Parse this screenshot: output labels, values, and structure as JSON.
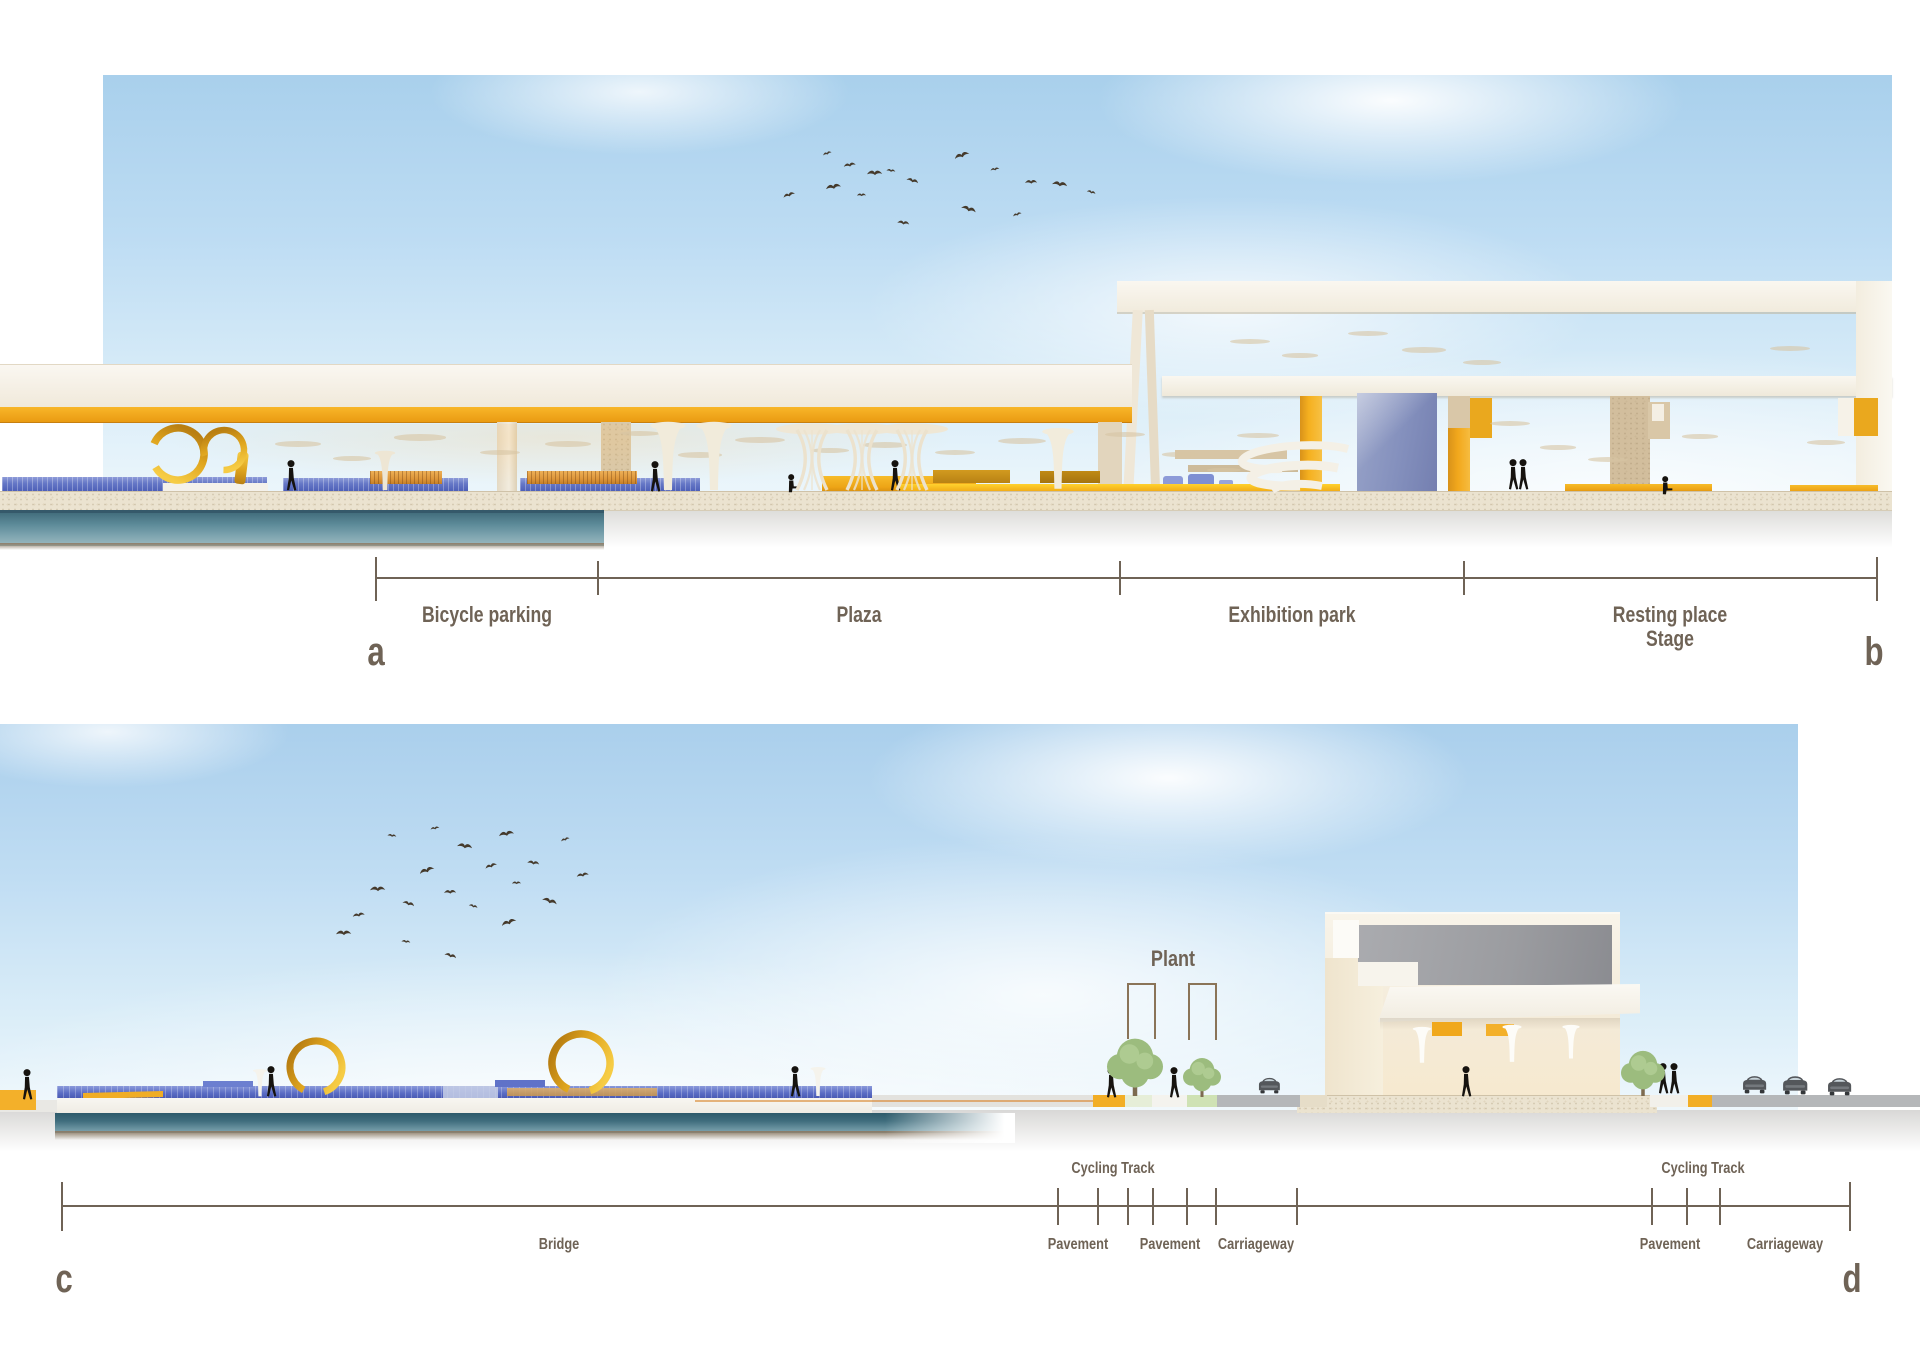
{
  "meta": {
    "sheet_type": "architectural section elevations",
    "panels": [
      "a-b",
      "c-d"
    ]
  },
  "colors": {
    "annotation": "#6f6356",
    "gold": "#dfa51e",
    "canopy_yellow": "#f2a81c",
    "bench_blue": "#6e7ec9",
    "water_teal": "#3f6d7d",
    "ground_beige": "#ebe3d0",
    "road_gray": "#b5b7b9",
    "sky_blue": "#b6d8f0"
  },
  "top_section": {
    "dim_line": {
      "y": 578,
      "x_start": 376,
      "x_end": 1877,
      "ticks": [
        376,
        598,
        1120,
        1464,
        1877
      ],
      "labels_below": [
        {
          "text": "Bicycle parking",
          "x": 487
        },
        {
          "text": "Plaza",
          "x": 859
        },
        {
          "text": "Exhibition park",
          "x": 1292
        },
        {
          "text": "Resting place",
          "text2": "Stage",
          "x": 1670
        }
      ],
      "labels_above": []
    },
    "markers": [
      {
        "text": "a",
        "x": 376,
        "y": 630
      },
      {
        "text": "b",
        "x": 1874,
        "y": 630
      }
    ]
  },
  "bottom_section": {
    "dim_line": {
      "y": 1206,
      "x_start": 62,
      "x_end": 1850,
      "ticks": [
        62,
        1058,
        1098,
        1128,
        1153,
        1187,
        1216,
        1297,
        1652,
        1687,
        1720,
        1850
      ],
      "labels_below": [
        {
          "text": "Bridge",
          "x": 559
        },
        {
          "text": "Pavement",
          "x": 1078
        },
        {
          "text": "Pavement",
          "x": 1170
        },
        {
          "text": "Carriageway",
          "x": 1256
        },
        {
          "text": "Pavement",
          "x": 1670
        },
        {
          "text": "Carriageway",
          "x": 1785
        }
      ],
      "labels_above": [
        {
          "text": "Cycling Track",
          "x": 1113
        },
        {
          "text": "Cycling Track",
          "x": 1703
        }
      ]
    },
    "markers": [
      {
        "text": "c",
        "x": 64,
        "y": 1257
      },
      {
        "text": "d",
        "x": 1852,
        "y": 1257
      }
    ],
    "plant_label": {
      "text": "Plant",
      "x": 1173,
      "y": 946
    }
  },
  "scene": {
    "birds_top": [
      [
        822,
        152
      ],
      [
        843,
        162
      ],
      [
        867,
        168
      ],
      [
        887,
        167
      ],
      [
        908,
        175
      ],
      [
        953,
        153
      ],
      [
        990,
        167
      ],
      [
        1025,
        178
      ],
      [
        1053,
        178
      ],
      [
        1088,
        188
      ],
      [
        782,
        193
      ],
      [
        825,
        183
      ],
      [
        857,
        192
      ],
      [
        898,
        218
      ],
      [
        963,
        202
      ],
      [
        1012,
        213
      ]
    ],
    "birds_bottom": [
      [
        352,
        912
      ],
      [
        370,
        884
      ],
      [
        388,
        832
      ],
      [
        404,
        898
      ],
      [
        418,
        868
      ],
      [
        430,
        826
      ],
      [
        444,
        888
      ],
      [
        458,
        840
      ],
      [
        470,
        902
      ],
      [
        484,
        864
      ],
      [
        498,
        830
      ],
      [
        512,
        880
      ],
      [
        528,
        858
      ],
      [
        544,
        894
      ],
      [
        560,
        838
      ],
      [
        576,
        872
      ],
      [
        336,
        928
      ],
      [
        402,
        938
      ],
      [
        446,
        950
      ],
      [
        500,
        920
      ]
    ],
    "people": [
      [
        284,
        460,
        "walk"
      ],
      [
        648,
        461,
        "walk"
      ],
      [
        786,
        474,
        "sit"
      ],
      [
        888,
        460,
        "walk"
      ],
      [
        1506,
        459,
        "walk"
      ],
      [
        1516,
        459,
        "walk"
      ],
      [
        1660,
        476,
        "sit"
      ],
      [
        20,
        1069,
        "walk"
      ],
      [
        264,
        1066,
        "walk"
      ],
      [
        788,
        1066,
        "walk"
      ],
      [
        1104,
        1067,
        "walk"
      ],
      [
        1167,
        1067,
        "walk"
      ],
      [
        1459,
        1066,
        "walk"
      ],
      [
        1656,
        1063,
        "walk"
      ],
      [
        1667,
        1063,
        "walk"
      ]
    ],
    "cars": [
      [
        1258,
        1075,
        0.95
      ],
      [
        1742,
        1073,
        1.05
      ],
      [
        1782,
        1073,
        1.1
      ],
      [
        1827,
        1075,
        1.05
      ]
    ],
    "trees": [
      [
        1135,
        1096,
        1.4
      ],
      [
        1202,
        1097,
        0.95
      ],
      [
        1643,
        1096,
        1.1
      ]
    ],
    "tulips": [
      [
        385,
        452,
        0.68,
        "#eee6d4"
      ],
      [
        668,
        424,
        1.18,
        "#f1ebdb"
      ],
      [
        714,
        424,
        1.18,
        "#f1ebdb"
      ],
      [
        1058,
        430,
        1.05,
        "#f2ecdc"
      ],
      [
        260,
        1070,
        0.47,
        "#f5f3ec"
      ],
      [
        818,
        1068,
        0.5,
        "#f5f3ec"
      ],
      [
        1422,
        1028,
        0.62,
        "#fdfcf8"
      ],
      [
        1512,
        1026,
        0.64,
        "#fdfcf8"
      ],
      [
        1571,
        1026,
        0.58,
        "#fdfcf8"
      ]
    ],
    "lattice_columns": [
      [
        812,
        428
      ],
      [
        862,
        428
      ],
      [
        912,
        428
      ]
    ],
    "rings": [
      {
        "cx": 178,
        "cy": 454,
        "r": 26,
        "sw": 7.5,
        "rot": 205,
        "open": 15
      },
      {
        "cx": 224,
        "cy": 450,
        "r": 20,
        "sw": 6.5,
        "rot": 165,
        "open": 20
      },
      {
        "cx": 316,
        "cy": 1067,
        "r": 26,
        "sw": 7,
        "rot": 120,
        "open": 13
      },
      {
        "cx": 581,
        "cy": 1063,
        "r": 29,
        "sw": 7.5,
        "rot": 115,
        "open": 12
      }
    ],
    "discs": [
      [
        298,
        441,
        46
      ],
      [
        352,
        456,
        38
      ],
      [
        420,
        434,
        52
      ],
      [
        500,
        450,
        40
      ],
      [
        568,
        441,
        46
      ],
      [
        640,
        431,
        40
      ],
      [
        700,
        452,
        44
      ],
      [
        760,
        437,
        50
      ],
      [
        830,
        448,
        38
      ],
      [
        885,
        442,
        44
      ],
      [
        955,
        450,
        40
      ],
      [
        1022,
        438,
        48
      ],
      [
        1125,
        432,
        40
      ],
      [
        1180,
        452,
        36
      ],
      [
        1224,
        468,
        34
      ],
      [
        1258,
        433,
        42
      ],
      [
        1310,
        445,
        38
      ],
      [
        1250,
        339,
        40
      ],
      [
        1300,
        353,
        36
      ],
      [
        1368,
        331,
        40
      ],
      [
        1424,
        347,
        44
      ],
      [
        1482,
        360,
        38
      ],
      [
        1510,
        421,
        40
      ],
      [
        1558,
        445,
        36
      ],
      [
        1608,
        457,
        40
      ],
      [
        1700,
        434,
        36
      ],
      [
        1790,
        346,
        40
      ],
      [
        1826,
        440,
        38
      ]
    ],
    "ground_strips": [
      {
        "name": "walkway",
        "x": 868,
        "w": 225,
        "color": "#e3e2de"
      },
      {
        "name": "cycle-track-yellow",
        "x": 1093,
        "w": 32,
        "color": "#f2ae26"
      },
      {
        "name": "verge-pale",
        "x": 1125,
        "w": 27,
        "color": "#e6eed8"
      },
      {
        "name": "pavement-strip",
        "x": 1152,
        "w": 35,
        "color": "#f4f3ee"
      },
      {
        "name": "verge-green",
        "x": 1187,
        "w": 30,
        "color": "#cfe2b4"
      },
      {
        "name": "carriageway-strip",
        "x": 1217,
        "w": 83,
        "color": "#b5b7b9"
      },
      {
        "name": "kerb-beige",
        "x": 1300,
        "w": 27,
        "color": "#e6ddc8"
      },
      {
        "name": "pavement-strip-2",
        "x": 1650,
        "w": 38,
        "color": "#f2f0ea"
      },
      {
        "name": "cycle-track-yellow-2",
        "x": 1688,
        "w": 24,
        "color": "#f2ae26"
      },
      {
        "name": "carriageway-strip-2",
        "x": 1712,
        "w": 208,
        "color": "#b5b7b9"
      }
    ]
  }
}
